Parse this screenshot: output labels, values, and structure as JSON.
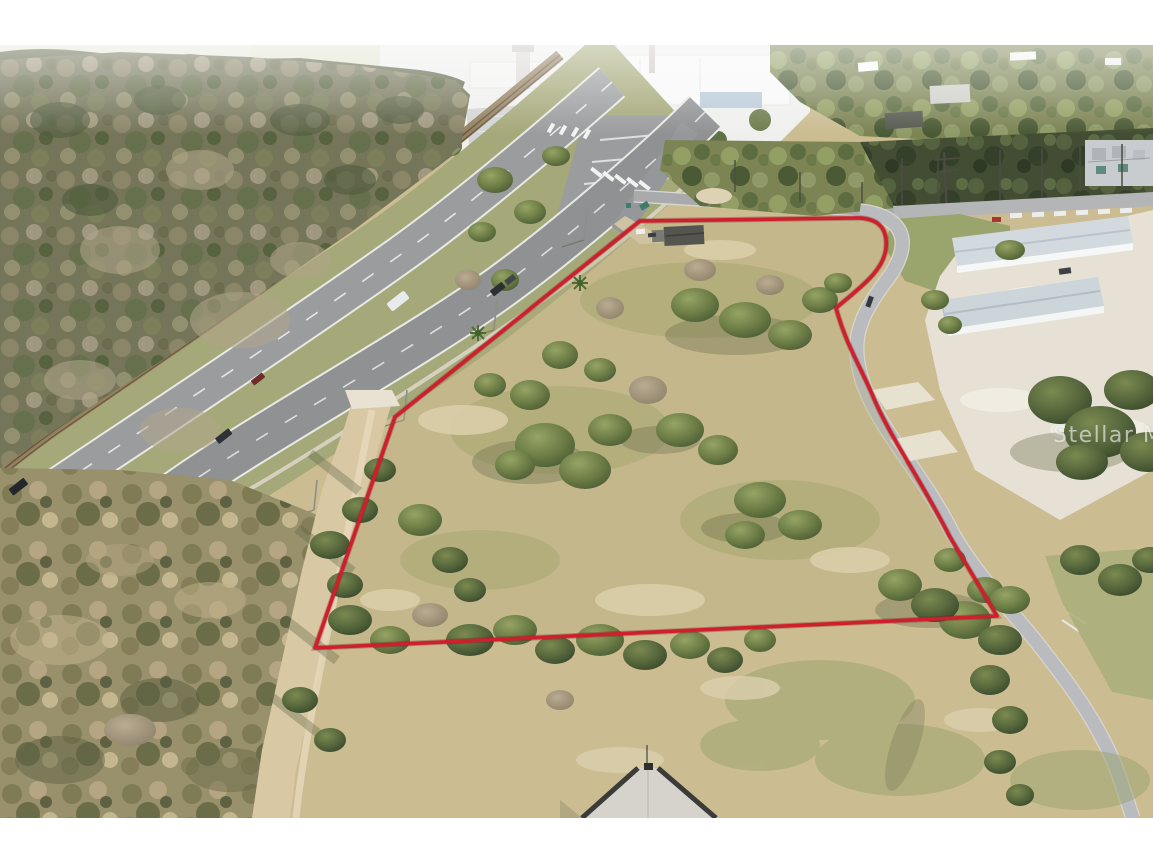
{
  "watermark": {
    "text": "Stellar MLS"
  },
  "colors": {
    "boundary_red": "#ce1f2d",
    "watermark_white": "rgba(255,255,255,0.58)",
    "margin_white": "#ffffff",
    "dry_grass_tan": "#cbbc92",
    "oak_green": "#6b7c45",
    "asphalt_gray": "#8f9193"
  },
  "photo": {
    "description": "Aerial drone photo of a vacant land parcel outlined in red, bordered by a divided highway and railroad on the northwest, a curved access road with metal warehouses on the east, scrubland with a dirt trail on the southwest, an industrial complex at top, and a house roof at bottom center."
  }
}
